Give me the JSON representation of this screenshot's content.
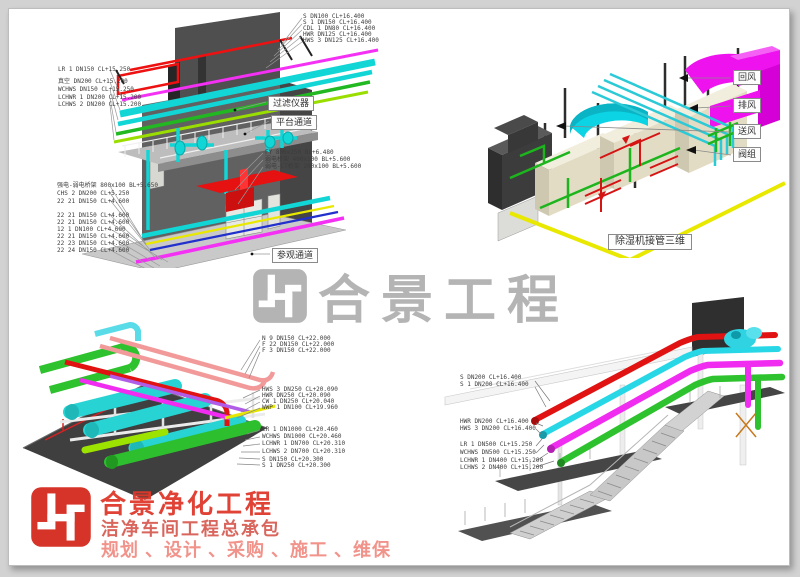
{
  "watermark": {
    "text": "合景工程"
  },
  "brand": {
    "title": "合景净化工程",
    "subtitle": "洁净车间工程总承包",
    "services": "规划 、设计 、采购 、施工 、维保"
  },
  "colors": {
    "brand_red": "#d63428",
    "watermark_gray": "#b4b4b4",
    "pipe_cyan": "#12d6d6",
    "pipe_magenta": "#f430f4",
    "pipe_red": "#e61111",
    "pipe_green": "#2ec22e",
    "pipe_yellow": "#e8e800"
  },
  "views": {
    "top_left": {
      "top_labels": [
        "S DN100 CL+16.400",
        "S 1 DN150 CL+16.400",
        "CDL 1 DN80 CL+16.400",
        "HWR DN125 CL+16.400",
        "HWS 3 DN125 CL+16.400"
      ],
      "left_labels": [
        "LR 1 DN150 CL+15.250",
        "真空 DN200 CL+15.200",
        "WCHWS DN150 CL+15.250",
        "LCHWR 1 DN200 CL+15.200",
        "LCHWS 2 DN200 CL+15.200"
      ],
      "mid_labels": [
        "FY 800x250 BL+6.480",
        "弱电桥架 400x100 BL+5.600",
        "弱电-CT桥架 200x100 BL+5.600"
      ],
      "bottom_labels": [
        "强电-弱电桥架 800x100 BL+5.650",
        "CHS 2 DN200 CL+5.250",
        "22 21 DN150 CL+4.600",
        "22 21 DN150 CL+4.600",
        "22 21 DN150 CL+4.600",
        "12 1 DN100 CL+4.600",
        "22 21 DN150 CL+4.600",
        "22 23 DN150 CL+4.600",
        "22 24 DN150 CL+4.600"
      ],
      "callouts": [
        "过滤仪器",
        "平台通道",
        "参观通道"
      ]
    },
    "top_right": {
      "callouts": [
        "回风",
        "排风",
        "送风",
        "阀组"
      ],
      "caption": "除湿机接管三维"
    },
    "bottom_left": {
      "labels_top": [
        "N 9 DN150 CL+22.000",
        "F 22 DN150 CL+22.000",
        "F 3 DN150 CL+22.000"
      ],
      "labels_mid": [
        "HWS 3 DN250 CL+20.090",
        "HWR DN250 CL+20.090",
        "CW 1 DN250 CL+20.040",
        "WWP 1 DN100 CL+19.960"
      ],
      "labels_bottom": [
        "LR 1 DN1000 CL+20.460",
        "WCHWS DN1000 CL+20.460",
        "LCHWR 1 DN700 CL+20.310",
        "LCHWS 2 DN700 CL+20.310",
        "S DN150 CL+20.300",
        "S 1 DN250 CL+20.300"
      ]
    },
    "bottom_right": {
      "labels_top": [
        "S DN200 CL+16.400",
        "S 1 DN200 CL+16.400"
      ],
      "labels_mid": [
        "HWR DN200 CL+16.400",
        "HWS 3 DN200 CL+16.400"
      ],
      "labels_bottom": [
        "LR 1 DN500 CL+15.250",
        "WCHWS DN500 CL+15.250",
        "LCHWR 1 DN400 CL+15.200",
        "LCHWS 2 DN400 CL+15.200"
      ]
    }
  }
}
